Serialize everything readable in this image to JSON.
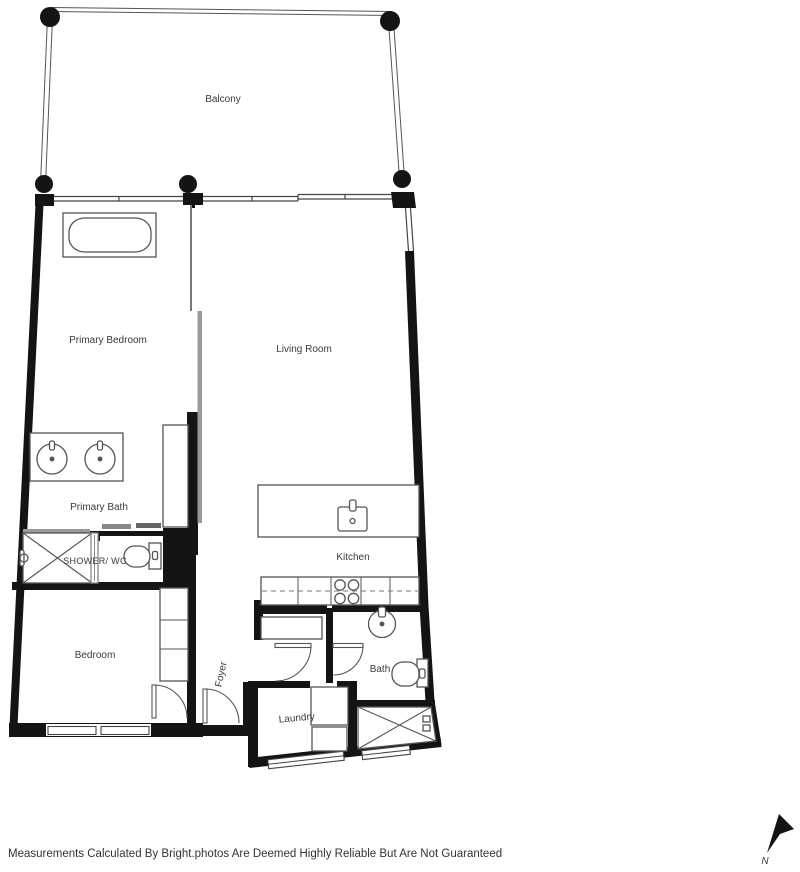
{
  "floor_plan": {
    "rooms": {
      "balcony": "Balcony",
      "primary_bedroom": "Primary Bedroom",
      "living_room": "Living Room",
      "primary_bath": "Primary Bath",
      "shower_wc": "SHOWER/ WC",
      "kitchen": "Kitchen",
      "bedroom": "Bedroom",
      "foyer": "Foyer",
      "bath": "Bath",
      "laundry": "Laundry"
    },
    "compass": {
      "north_label": "N"
    },
    "footer": {
      "disclaimer": "Measurements Calculated By Bright.photos Are Deemed Highly Reliable But Are Not Guaranteed"
    },
    "colors": {
      "wall": "#141414",
      "fixture_line": "#555555",
      "window_line": "#444444",
      "glass": "#999999",
      "label_text": "#3a3a3a",
      "background": "#ffffff"
    }
  }
}
